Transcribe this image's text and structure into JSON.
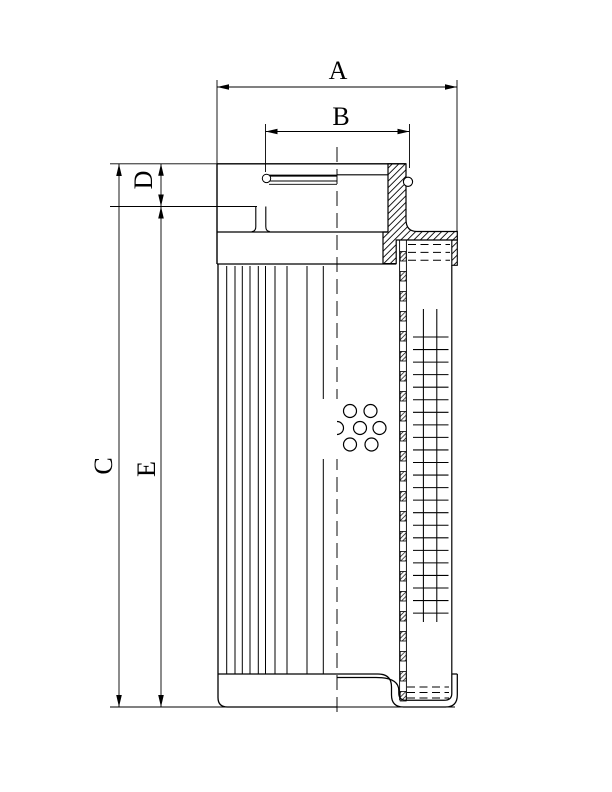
{
  "drawing": {
    "dimension_labels": {
      "A": "A",
      "B": "B",
      "C": "C",
      "D": "D",
      "E": "E"
    }
  }
}
